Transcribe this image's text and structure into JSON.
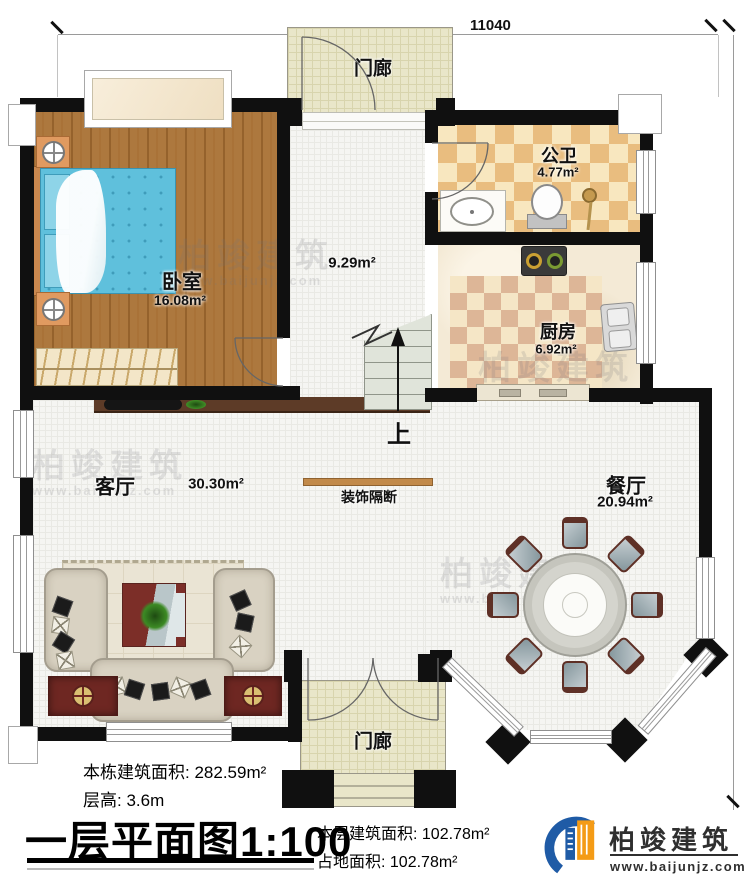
{
  "plan": {
    "dimensions": {
      "width_mm": "11040",
      "height_mm": "12590"
    },
    "rooms": {
      "porch_top": {
        "label": "门廊"
      },
      "bedroom": {
        "label": "卧室",
        "area": "16.08m²"
      },
      "hallway": {
        "area": "9.29m²"
      },
      "bathroom": {
        "label": "公卫",
        "area": "4.77m²"
      },
      "kitchen": {
        "label": "厨房",
        "area": "6.92m²"
      },
      "living": {
        "label": "客厅",
        "area": "30.30m²"
      },
      "dining": {
        "label": "餐厅",
        "area": "20.94m²"
      },
      "porch_bottom": {
        "label": "门廊"
      }
    },
    "features": {
      "partition_label": "装饰隔断",
      "stairs_up_label": "上"
    }
  },
  "footer": {
    "building_area_label": "本栋建筑面积:",
    "building_area_value": "282.59m²",
    "floor_height_label": "层高:",
    "floor_height_value": "3.6m",
    "title": "一层平面图",
    "scale": "1:100",
    "floor_area_label": "本层建筑面积:",
    "floor_area_value": "102.78m²",
    "land_area_label": "占地面积:",
    "land_area_value": "102.78m²"
  },
  "brand": {
    "name": "柏竣建筑",
    "website": "www.baijunjz.com"
  },
  "watermark": {
    "text": "柏竣建筑",
    "website": "www.baijunjz.com"
  },
  "colors": {
    "wall": "#101010",
    "partition_bar": "#c28a4a",
    "tile_tan": "#e9bd7f",
    "tile_cream": "#f8e7bf",
    "wood": "#ad783e",
    "porch": "#e9e6c9"
  }
}
